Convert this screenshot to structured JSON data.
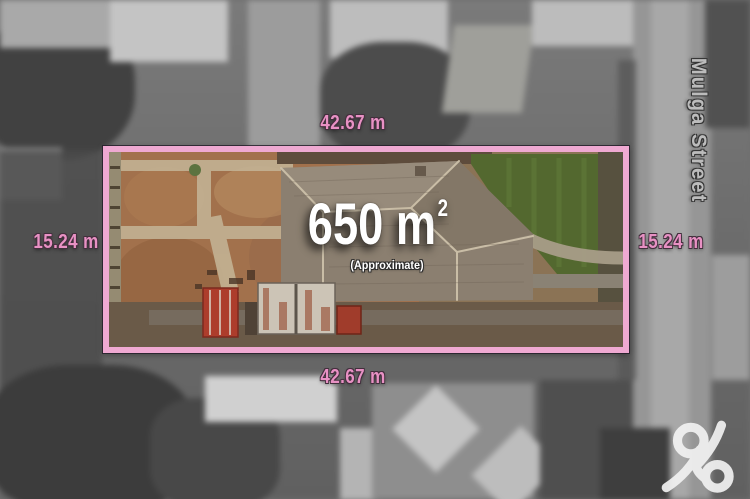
{
  "dimensions": {
    "top": "42.67 m",
    "bottom": "42.67 m",
    "left": "15.24 m",
    "right": "15.24 m"
  },
  "area": {
    "value": "650 m",
    "superscript": "2",
    "qualifier": "(Approximate)"
  },
  "street": {
    "name": "Mulga Street"
  },
  "logo": {
    "glyph": "ampersand"
  },
  "colors": {
    "boundary_pink": "#efa9d2",
    "label_pink": "#e891c4",
    "area_text": "#ffffff",
    "street_text": "#bcbcbc"
  }
}
